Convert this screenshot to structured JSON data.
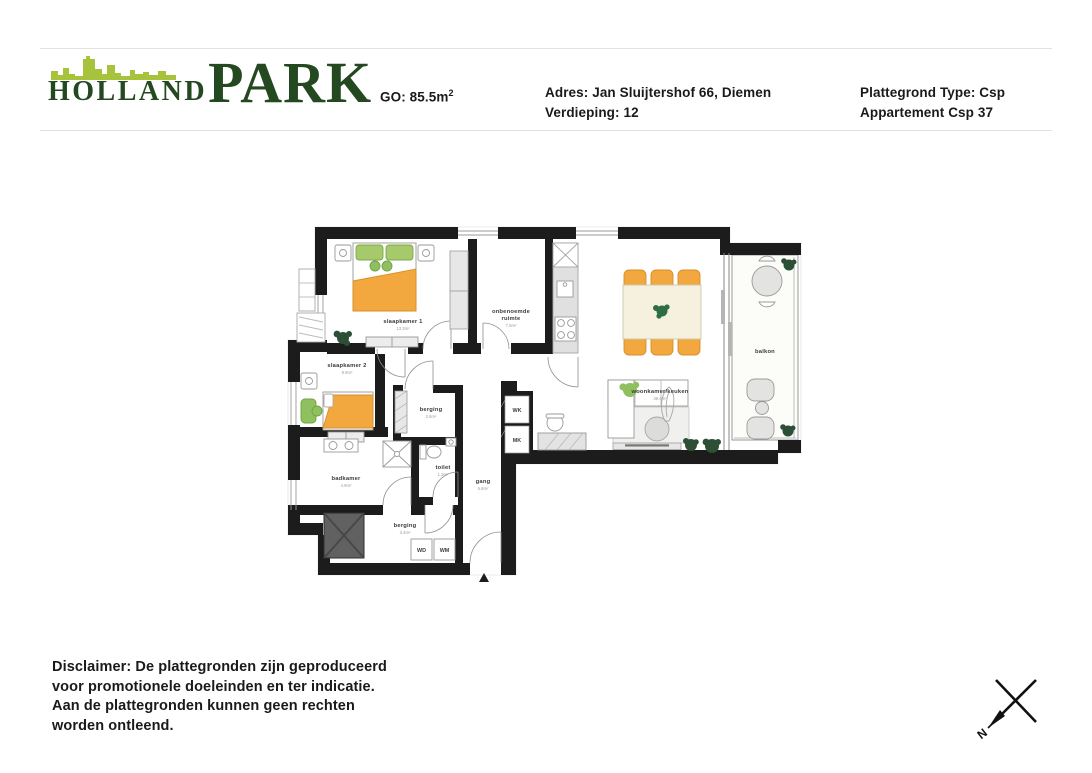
{
  "header": {
    "logo": {
      "word1": "HOLLAND",
      "word2": "PARK"
    },
    "go": {
      "label": "GO: 85.5m",
      "sup": "2"
    },
    "address": {
      "line1": "Adres: Jan Sluijtershof 66, Diemen",
      "line2": "Verdieping: 12"
    },
    "plan_type": {
      "line1": "Plattegrond Type: Csp",
      "line2": "Appartement Csp 37"
    }
  },
  "floorplan": {
    "rooms": {
      "slaapkamer1": {
        "label": "slaapkamer 1",
        "area": "13.3m²"
      },
      "slaapkamer2": {
        "label": "slaapkamer 2",
        "area": "9.9m²"
      },
      "onbenoemde": {
        "label1": "onbenoemde",
        "label2": "ruimte",
        "area": "7.5m²"
      },
      "woonkamer": {
        "label": "woonkamer/keuken",
        "area": "39.4m²"
      },
      "balkon": {
        "label": "balkon"
      },
      "berging1": {
        "label": "berging",
        "area": "2.6m²"
      },
      "toilet": {
        "label": "toilet",
        "area": "1.3m²"
      },
      "badkamer": {
        "label": "badkamer",
        "area": "4.9m²"
      },
      "gang": {
        "label": "gang",
        "area": "5.6m²"
      },
      "berging2": {
        "label": "berging",
        "area": "3.4m²"
      }
    },
    "appliances": {
      "wd": "WD",
      "wm": "WM",
      "wk": "WK",
      "mk": "MK"
    }
  },
  "footer": {
    "disclaimer_lines": [
      "Disclaimer: De plattegronden zijn geproduceerd",
      "voor promotionele doeleinden en ter indicatie.",
      "Aan de plattegronden kunnen geen rechten",
      "worden ontleend."
    ],
    "compass_label": "N"
  }
}
